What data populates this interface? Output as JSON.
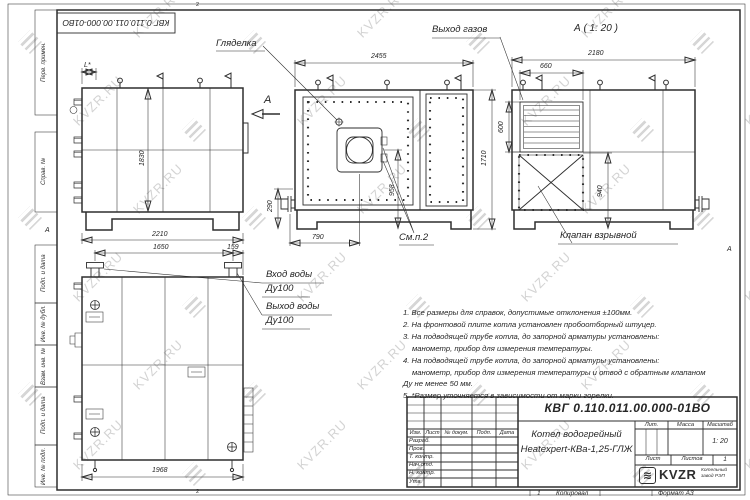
{
  "watermark": {
    "text": "KVZR.RU"
  },
  "colors": {
    "line": "#2e2e2e",
    "watermark": "#c9c9c9",
    "paper": "#ffffff"
  },
  "frame": {
    "top_stamp": "КВГ 0.110.011.00.000-01ВО",
    "zone_top": "2",
    "zone_bottom": "2",
    "fold_left": "А",
    "fold_right": "А",
    "left_labels": {
      "perv": "Перв. примен.",
      "sprav": "Справ. №",
      "podp1": "Подп. и дата",
      "inv_dubl": "Инв. № дубл.",
      "vzam": "Взам. инв. №",
      "podp2": "Подп. и дата",
      "inv_podl": "Инв. № подл."
    }
  },
  "views": {
    "side": {
      "dim_l": "L*",
      "dim_h": "1830",
      "dim_w": "2210",
      "section": "А"
    },
    "front": {
      "title_sight": "Гляделка",
      "dim_w": "2455",
      "dim_burner": "958",
      "dim_x": "790",
      "dim_base": "290",
      "dim_h": "1710",
      "see_item": "См.п.2"
    },
    "rear": {
      "view_label": "А ( 1: 20 )",
      "gas_label": "Выход газов",
      "valve_label": "Клапан взрывной",
      "dim_w": "2180",
      "dim_grille_w": "660",
      "dim_grille_h": "600",
      "dim_valve": "940"
    },
    "plan": {
      "inlet_1": "Вход воды",
      "inlet_2": "Ду100",
      "outlet_1": "Выход воды",
      "outlet_2": "Ду100",
      "dim_span": "1650",
      "dim_edge": "159",
      "dim_len": "1968"
    }
  },
  "notes": {
    "line1": "1. Все размеры для справок, допустимые отклонения ±100мм.",
    "line2": "2. На фронтовой плите котла установлен пробоотборный штуцер.",
    "line3": "3. На подводящей трубе котла, до запорной арматуры установлены:",
    "line4": "манометр, прибор для измерения температуры.",
    "line5": "4. На подводящей трубе котла, до запорной арматуры установлены:",
    "line6": "манометр, прибор для измерения температуры и отвод с обратным клапаном",
    "line7": "Ду не менее 50 мм.",
    "line8": "5. *Размер уточняется в зависимости от марки горелки."
  },
  "titleblock": {
    "doc_number": "КВГ 0.110.011.00.000-01ВО",
    "name_line1": "Котел водогрейный",
    "name_line2": "Heatexpert-КВа-1,25-ГЛЖ",
    "h_izm": "Изм.",
    "h_list": "Лист",
    "h_doc": "№ докум.",
    "h_podp": "Подп.",
    "h_data": "Дата",
    "r1": "Разраб.",
    "r2": "Пров.",
    "r3": "Т. контр.",
    "r4": "Нач.отд.",
    "r5": "Н. контр.",
    "r6": "Утв.",
    "lit": "Лит.",
    "mass": "Масса",
    "scale": "Масштаб",
    "scale_value": "1: 20",
    "sheet": "Лист",
    "sheets": "Листов",
    "sheets_value": "1",
    "logo_icon": "≋",
    "logo": "KVZR",
    "company_line1": "Котельный",
    "company_line2": "завод РЭП",
    "copy_num": "1",
    "copied": "Копировал",
    "format": "Формат А3"
  }
}
